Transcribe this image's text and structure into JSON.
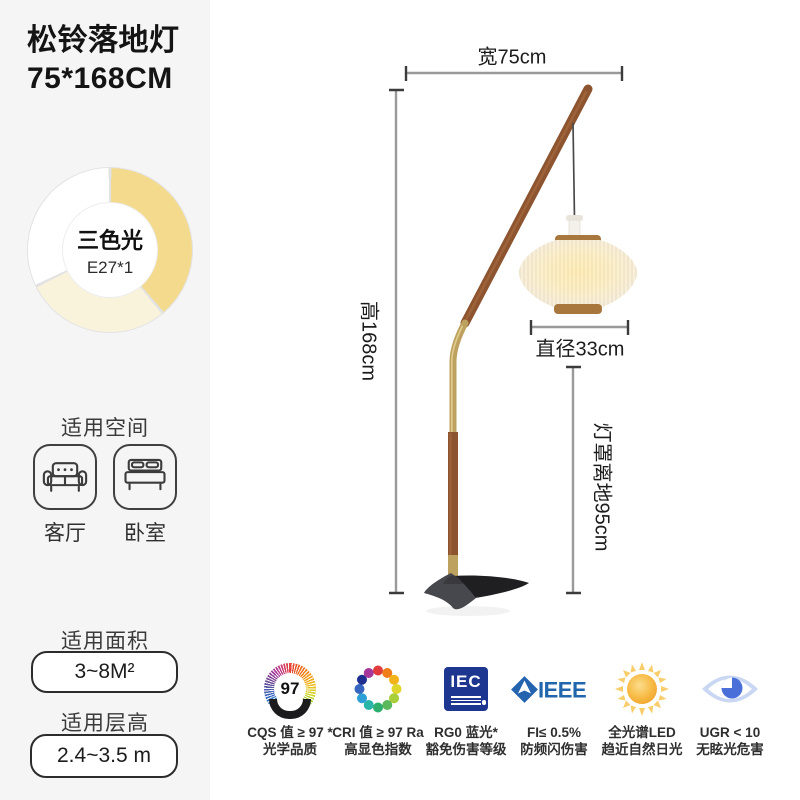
{
  "product": {
    "title_line1": "松铃落地灯",
    "title_line2": "75*168CM"
  },
  "light_source": {
    "label": "三色光",
    "bulb": "E27*1",
    "segment_colors": {
      "warm_yellow": "#f3da8c",
      "cream": "#faf3dc",
      "white": "#ffffff"
    }
  },
  "sections": {
    "space": {
      "heading": "适用空间",
      "items": [
        {
          "icon": "sofa-icon",
          "label": "客厅"
        },
        {
          "icon": "bed-icon",
          "label": "卧室"
        }
      ]
    },
    "area": {
      "heading": "适用面积",
      "value": "3~8M²"
    },
    "floor": {
      "heading": "适用层高",
      "value": "2.4~3.5 m"
    }
  },
  "dimensions": {
    "width": "宽75cm",
    "height": "高168cm",
    "diameter": "直径33cm",
    "shade_to_floor": "灯罩离地95cm"
  },
  "badges": [
    {
      "icon": "cqs-97-medal-icon",
      "value": "97",
      "line1": "CQS 值 ≥ 97 *",
      "line2": "光学品质"
    },
    {
      "icon": "cri-color-wheel-icon",
      "line1": "CRI 值 ≥ 97 Ra",
      "line2": "高显色指数"
    },
    {
      "icon": "iec-logo-icon",
      "logo_text": "IEC",
      "line1": "RG0 蓝光*",
      "line2": "豁免伤害等级"
    },
    {
      "icon": "ieee-logo-icon",
      "logo_text": "IEEE",
      "line1": "FI≤ 0.5%",
      "line2": "防频闪伤害"
    },
    {
      "icon": "sun-icon",
      "line1": "全光谱LED",
      "line2": "趋近自然日光"
    },
    {
      "icon": "eye-icon",
      "line1": "UGR < 10",
      "line2": "无眩光危害"
    }
  ],
  "colors": {
    "sidebar_bg": "#f5f5f6",
    "wood": "#8d5430",
    "brass": "#bda15f",
    "shade_glow": "#ffeebb",
    "base_dark": "#1f1f22",
    "dimension_line": "#9a9a9a",
    "iec_blue": "#1d3690",
    "ieee_blue": "#2166ac"
  }
}
